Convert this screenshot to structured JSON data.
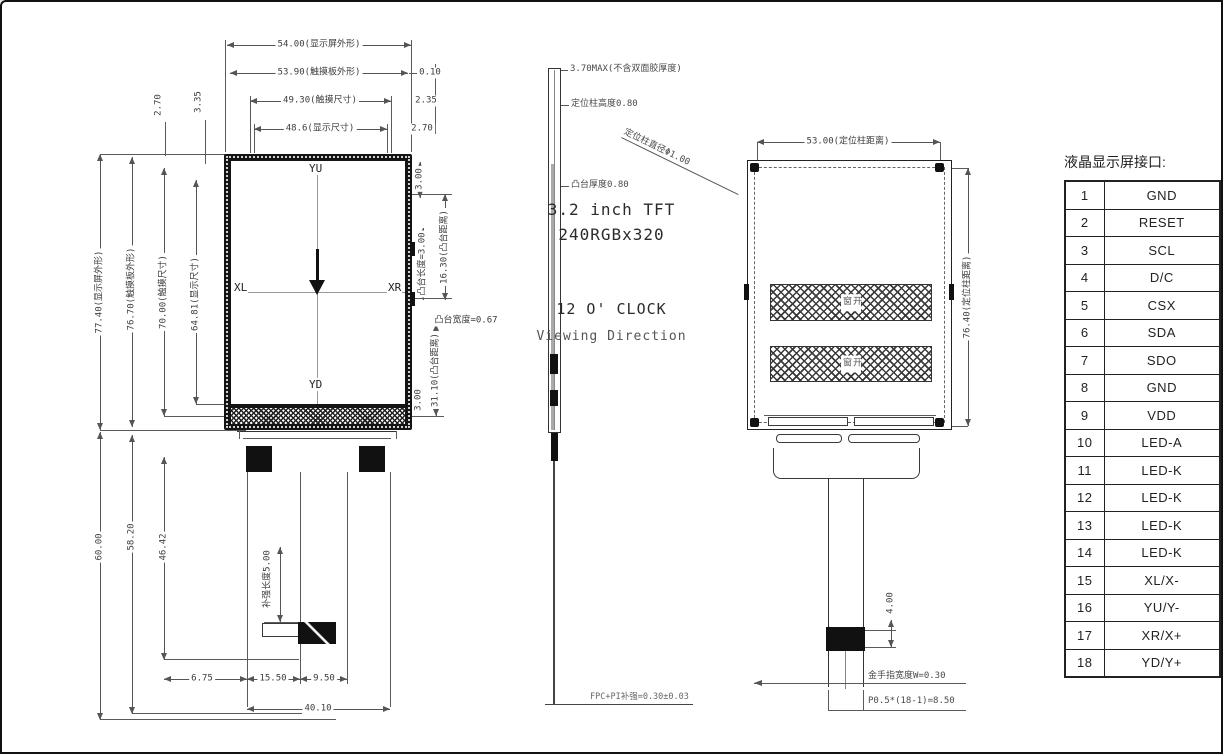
{
  "front_view": {
    "top_dims": [
      {
        "label": "54.00(显示屏外形)"
      },
      {
        "label": "53.90(触摸板外形)",
        "offset": "0.10"
      },
      {
        "label": "49.30(触摸尺寸)",
        "offset": "2.35"
      },
      {
        "label": "48.6(显示尺寸)",
        "offset": "2.70"
      }
    ],
    "gap_dims": [
      "2.70",
      "3.35"
    ],
    "left_dims": [
      "77.40(显示屏外形)",
      "76.70(触摸板外形)",
      "70.00(触摸尺寸)",
      "64.81(显示尺寸)"
    ],
    "left_lower_dims": [
      "60.00",
      "58.20",
      "46.42"
    ],
    "right_dims": [
      "3.00",
      "凸台长度=3.00",
      "16.30(凸台距离)",
      "凸台宽度=0.67",
      "31.10(凸台距离)",
      "3.00"
    ],
    "screen": {
      "size_line": "3.2 inch TFT",
      "resolution_line": "240RGBx320",
      "clock_line": "12 O' CLOCK",
      "direction_line": "Viewing Direction",
      "axis_top": "YU",
      "axis_bottom": "YD",
      "axis_left": "XL",
      "axis_right": "XR"
    },
    "stiffener_label": "补强长度5.00",
    "bottom_dims": [
      "6.75",
      "15.50",
      "9.50",
      "40.10"
    ]
  },
  "side_view": {
    "thickness_note": "3.70MAX(不含双面胶厚度)",
    "post_height_note": "定位柱高度0.80",
    "boss_thickness_note": "凸台厚度0.80",
    "post_diameter_note": "定位柱直径Φ1.00",
    "fpc_note": "FPC+PI补强=0.30±0.03"
  },
  "back_view": {
    "top_dim": "53.00(定位柱距离)",
    "right_dim": "76.40(定位柱距离)",
    "window_label": "开窗",
    "window_label_2": "开窗",
    "tail_dim": "4.00",
    "finger_note": "金手指宽度W=0.30",
    "pitch_note": "P0.5*(18-1)=8.50"
  },
  "pin_table": {
    "title": "液晶显示屏接口:",
    "pins": [
      {
        "no": "1",
        "name": "GND"
      },
      {
        "no": "2",
        "name": "RESET"
      },
      {
        "no": "3",
        "name": "SCL"
      },
      {
        "no": "4",
        "name": "D/C"
      },
      {
        "no": "5",
        "name": "CSX"
      },
      {
        "no": "6",
        "name": "SDA"
      },
      {
        "no": "7",
        "name": "SDO"
      },
      {
        "no": "8",
        "name": "GND"
      },
      {
        "no": "9",
        "name": "VDD"
      },
      {
        "no": "10",
        "name": "LED-A"
      },
      {
        "no": "11",
        "name": "LED-K"
      },
      {
        "no": "12",
        "name": "LED-K"
      },
      {
        "no": "13",
        "name": "LED-K"
      },
      {
        "no": "14",
        "name": "LED-K"
      },
      {
        "no": "15",
        "name": "XL/X-"
      },
      {
        "no": "16",
        "name": "YU/Y-"
      },
      {
        "no": "17",
        "name": "XR/X+"
      },
      {
        "no": "18",
        "name": "YD/Y+"
      }
    ]
  }
}
